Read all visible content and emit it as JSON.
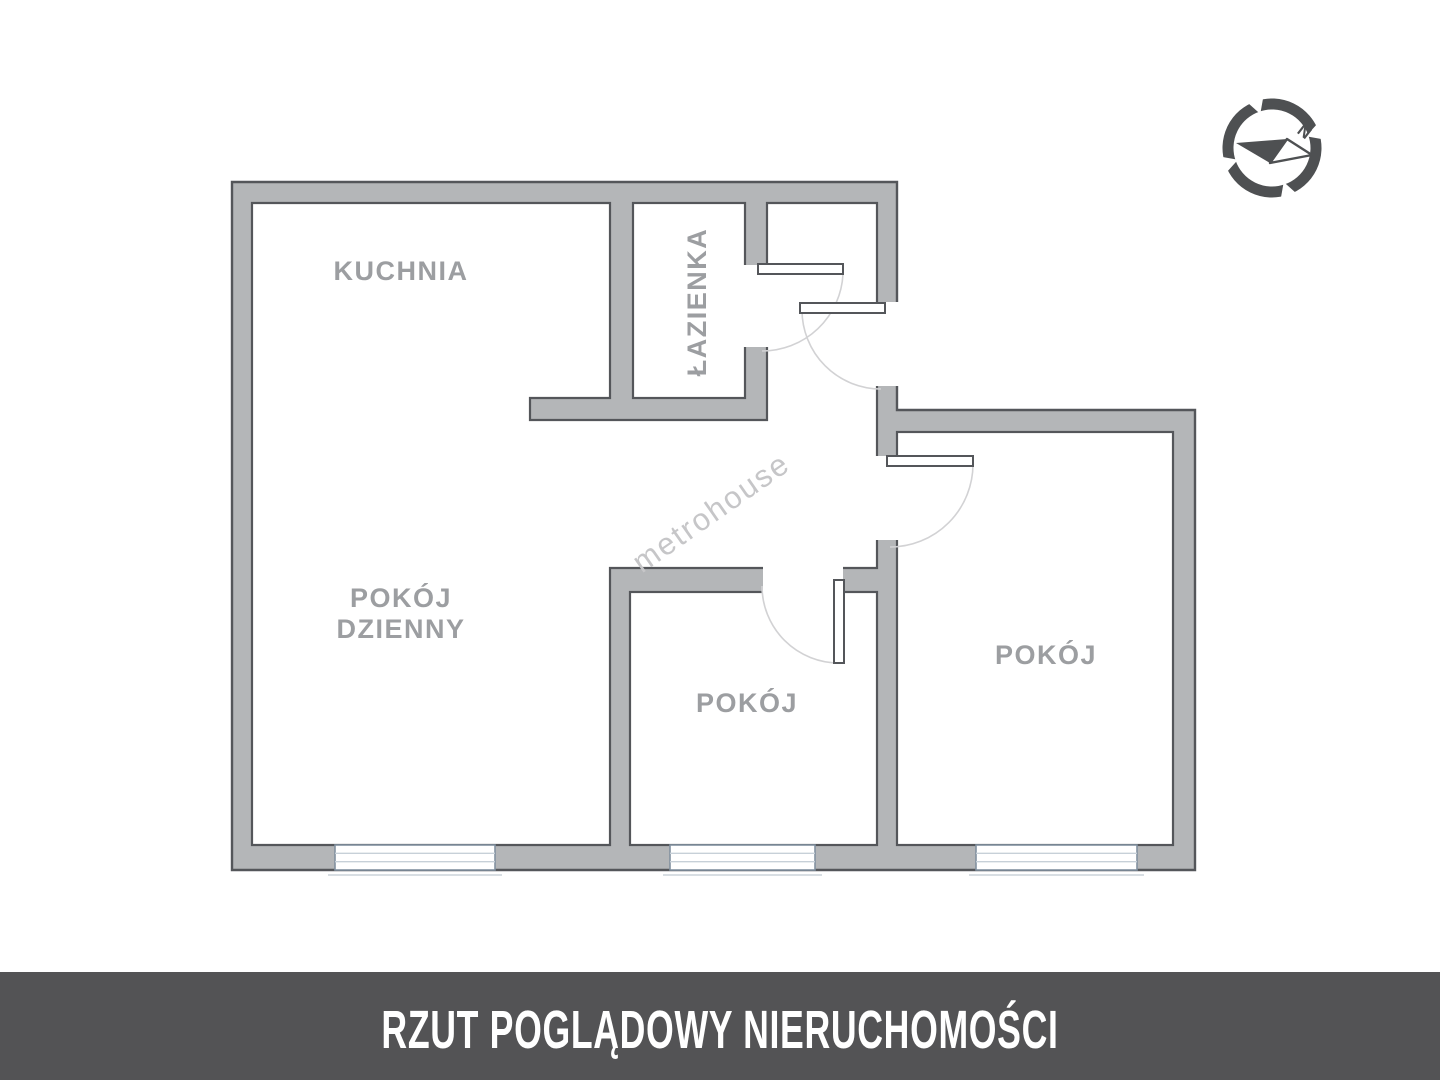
{
  "floor_plan": {
    "rooms": {
      "kitchen": {
        "label": "KUCHNIA"
      },
      "bathroom": {
        "label": "ŁAZIENKA"
      },
      "living_room": {
        "label_line1": "POKÓJ",
        "label_line2": "DZIENNY"
      },
      "middle_room": {
        "label": "POKÓJ"
      },
      "right_room": {
        "label": "POKÓJ"
      }
    },
    "window_count": 3,
    "door_count": 4
  },
  "watermark": {
    "text": "metrohouse"
  },
  "compass": {
    "north_label": "N"
  },
  "footer": {
    "title": "RZUT POGLĄDOWY NIERUCHOMOŚCI"
  },
  "colors": {
    "wall_fill": "#b4b6b8",
    "wall_outline": "#54565a",
    "room_label": "#9c9ea1",
    "watermark": "#c6c6c8",
    "door_arc": "#d2d2d4",
    "window_frame": "#8291a0",
    "footer_background": "#535355",
    "footer_text": "#ffffff"
  }
}
